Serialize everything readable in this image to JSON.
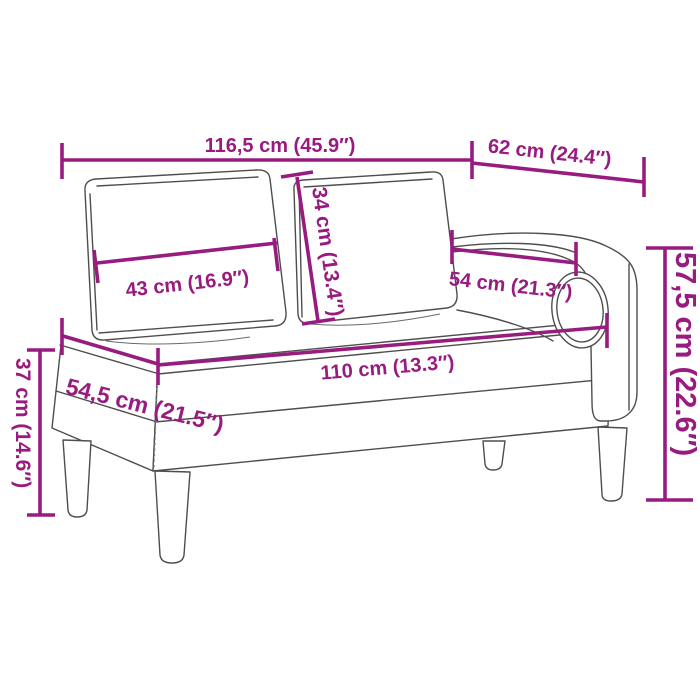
{
  "page": {
    "type": "product-dimension-diagram",
    "subject": "Chaise longue line drawing with two back cushions, right armrest and bolster cushion, annotated with measurements",
    "background": "#FFFFFF"
  },
  "colors": {
    "dimension_accent": "#981B80",
    "line_art": "#4E4E4E",
    "background": "#FFFFFF"
  },
  "dimensions": {
    "total_length": {
      "label": "116,5 cm (45.9″)"
    },
    "right_section_depth": {
      "label": "62 cm (24.4″)"
    },
    "back_cushion_height": {
      "label": "34 cm (13.4″)"
    },
    "back_cushion_width": {
      "label": "43 cm (16.9″)"
    },
    "armrest_length": {
      "label": "54 cm (21.3″)"
    },
    "seat_length": {
      "label": "110 cm (13.3″)"
    },
    "total_height": {
      "label": "57,5 cm (22.6″)"
    },
    "seat_depth": {
      "label": "54,5 cm (21.5″)"
    },
    "seat_height": {
      "label": "37 cm (14.6″)"
    }
  }
}
